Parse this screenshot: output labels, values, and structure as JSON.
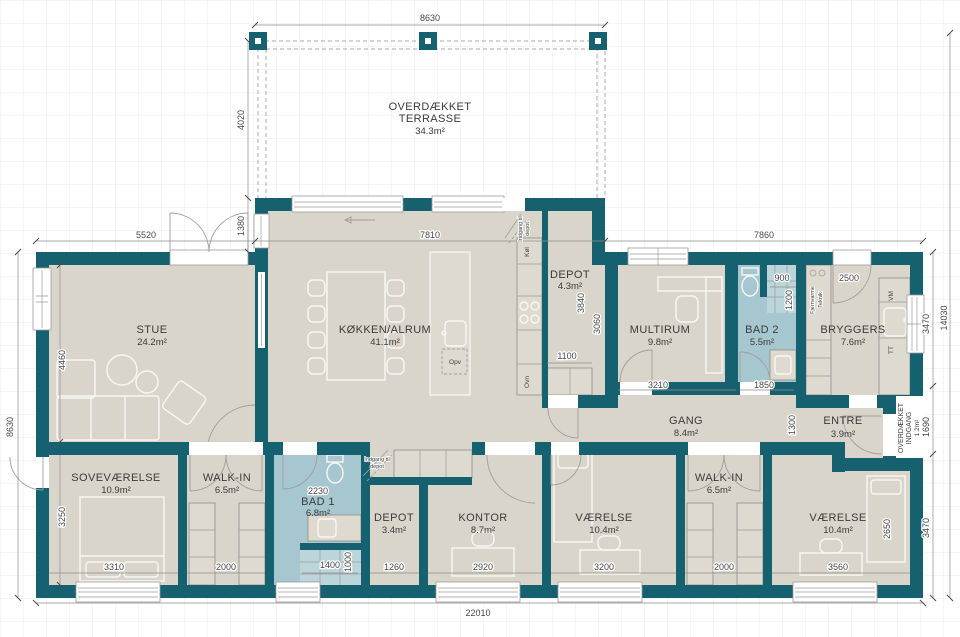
{
  "plan_title": "Floor plan",
  "rooms": {
    "terrasse": {
      "line1": "OVERDÆKKET",
      "line2": "TERRASSE",
      "area": "34.3m²"
    },
    "stue": {
      "name": "STUE",
      "area": "24.2m²"
    },
    "kokken": {
      "name": "KØKKEN/ALRUM",
      "area": "41.1m²"
    },
    "depot_top": {
      "name": "DEPOT",
      "area": "4.3m²"
    },
    "multirum": {
      "name": "MULTIRUM",
      "area": "9.8m²"
    },
    "bad2": {
      "name": "BAD 2",
      "area": "5.5m²"
    },
    "bryggers": {
      "name": "BRYGGERS",
      "area": "7.6m²"
    },
    "entre": {
      "name": "ENTRE",
      "area": "3.9m²"
    },
    "indgang": {
      "line1": "OVERDÆKKET",
      "line2": "INDGANG",
      "area": "1.2m²"
    },
    "gang": {
      "name": "GANG",
      "area": "8.4m²"
    },
    "sovevaerelse": {
      "name": "SOVEVÆRELSE",
      "area": "10.9m²"
    },
    "walkin_l": {
      "name": "WALK-IN",
      "area": "6.5m²"
    },
    "bad1": {
      "name": "BAD 1",
      "area": "6.8m²"
    },
    "depot_b": {
      "name": "DEPOT",
      "area": "3.4m²"
    },
    "kontor": {
      "name": "KONTOR",
      "area": "8.7m²"
    },
    "vaerelse_c": {
      "name": "VÆRELSE",
      "area": "10.4m²"
    },
    "walkin_r": {
      "name": "WALK-IN",
      "area": "6.5m²"
    },
    "vaerelse_r": {
      "name": "VÆRELSE",
      "area": "10.4m²"
    }
  },
  "appliances": {
    "kol": "Køl",
    "ovn": "Ovn",
    "opv": "Opv",
    "vm": "VM",
    "tt": "TT",
    "fjv1": "Fjernvarme",
    "fjv2": "Teknik",
    "depot_entry1": "Indgang til",
    "depot_entry2": "depot"
  },
  "dims": {
    "t8630": "8630",
    "t4020": "4020",
    "t1380": "1380",
    "t5520": "5520",
    "t7810": "7810",
    "t7860": "7860",
    "l8630": "8630",
    "l4460": "4460",
    "l3250": "3250",
    "r3470a": "3470",
    "r14030": "14030",
    "r1690": "1690",
    "r3470b": "3470",
    "b22010": "22010",
    "d3840": "3840",
    "d1100": "1100",
    "d3060": "3060",
    "d3210": "3210",
    "d900": "900",
    "d1200": "1200",
    "d1850": "1850",
    "d2500": "2500",
    "d1300": "1300",
    "d2650": "2650",
    "d3310": "3310",
    "d2000a": "2000",
    "d2230": "2230",
    "d1400": "1400",
    "d1000": "1000",
    "d1260": "1260",
    "d2920": "2920",
    "d3200": "3200",
    "d2000b": "2000",
    "d3560": "3560"
  },
  "colors": {
    "wall": "#16616f",
    "floor": "#d9d5ca",
    "bath": "#a6c7d0",
    "background": "#ffffff"
  }
}
